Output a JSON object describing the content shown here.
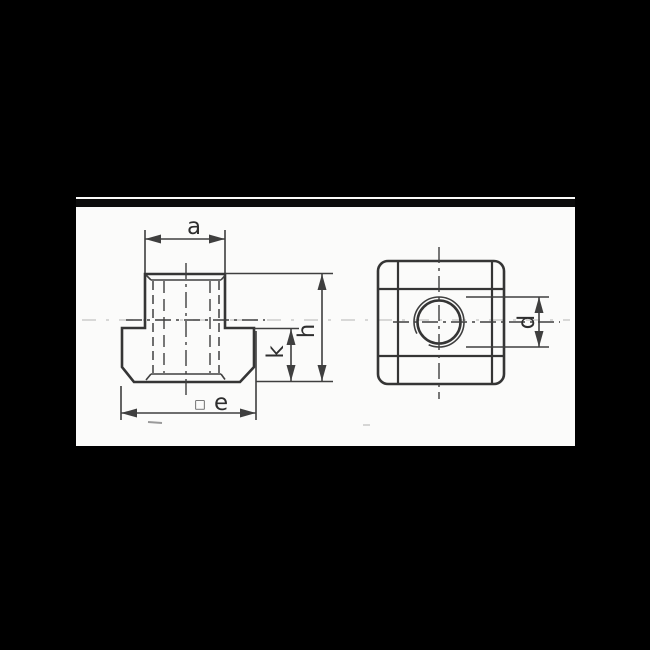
{
  "labels": {
    "a": "a",
    "e_prefix": "□",
    "e": "e",
    "k": "k",
    "h": "h",
    "d": "d"
  },
  "colors": {
    "background": "#000000",
    "paper": "#fbfbfa",
    "band": "#0b0b0b",
    "line": "#353535",
    "dim": "#3f3f3f",
    "faint": "#c2c2c2",
    "text": "#2e2e2e"
  }
}
